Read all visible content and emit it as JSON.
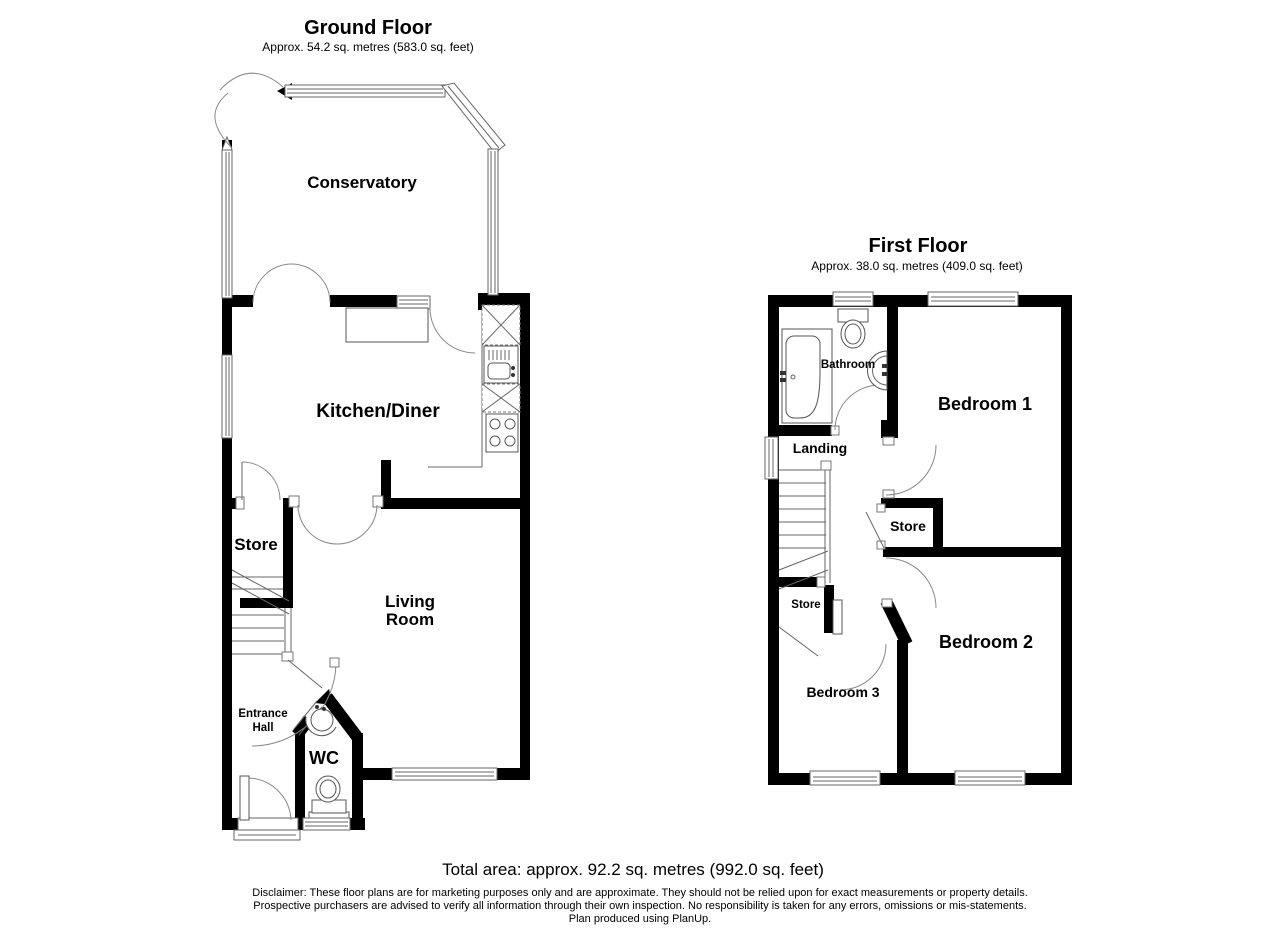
{
  "ground": {
    "title": "Ground Floor",
    "subtitle": "Approx. 54.2 sq. metres (583.0 sq. feet)",
    "rooms": {
      "conservatory": "Conservatory",
      "kitchen": "Kitchen/Diner",
      "store": "Store",
      "living1": "Living",
      "living2": "Room",
      "hall1": "Entrance",
      "hall2": "Hall",
      "wc": "WC"
    }
  },
  "first": {
    "title": "First Floor",
    "subtitle": "Approx. 38.0 sq. metres (409.0 sq. feet)",
    "rooms": {
      "bathroom": "Bathroom",
      "bedroom1": "Bedroom 1",
      "landing": "Landing",
      "store_upper": "Store",
      "store_lower": "Store",
      "bedroom2": "Bedroom 2",
      "bedroom3": "Bedroom 3"
    }
  },
  "footer": {
    "total_area": "Total area: approx. 92.2 sq. metres (992.0 sq. feet)",
    "disclaimer1": "Disclaimer: These floor plans are for marketing purposes only and are approximate. They should not be relied upon for exact measurements or property details.",
    "disclaimer2": "Prospective purchasers are advised to verify all information through their own inspection. No responsibility is taken for any errors, omissions or mis-statements.",
    "disclaimer3": "Plan produced using PlanUp."
  },
  "colors": {
    "wall": "#000000",
    "line": "#666666",
    "background": "#ffffff"
  }
}
